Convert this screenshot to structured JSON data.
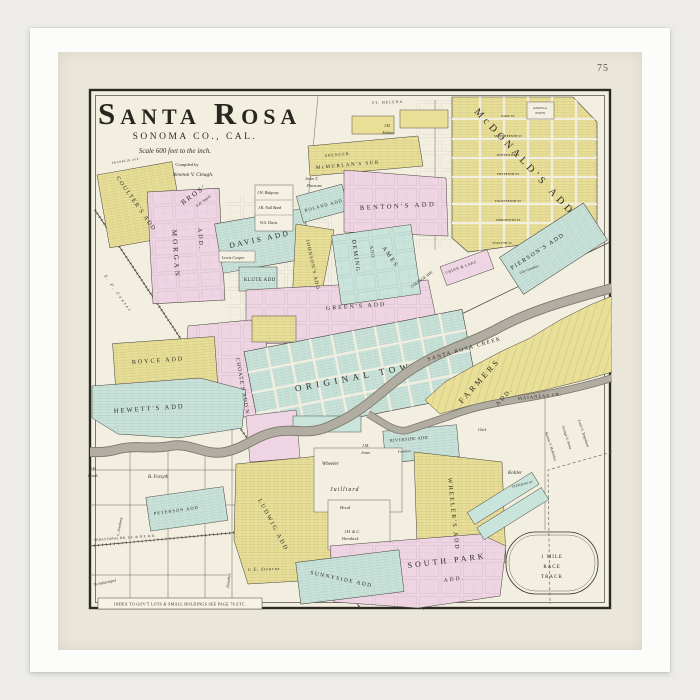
{
  "frame": {
    "page_number": "75"
  },
  "title": {
    "main": "Santa Rosa",
    "county": "SONOMA CO., CAL.",
    "scale": "Scale 600 feet to the inch.",
    "compiled": "Compiled by",
    "compiler": "Newton V. Cleugh."
  },
  "index_note": "INDEX TO GOV'T LOTS & SMALL HOLDINGS SEE PAGE 76 ETC.",
  "colors": {
    "yellow": "#e9df97",
    "pink": "#efd5e3",
    "teal": "#c9e4db",
    "paper": "#f2eee0",
    "creek": "#b2ada2",
    "ink": "#2e2b25"
  },
  "additions": {
    "coulter": "COULTER'S ADD",
    "morgan": "MORGAN",
    "morgan_bros": "BROS'",
    "morgan_add": "ADD.",
    "morgan_sub": "E.H. Smyth",
    "davis": "DAVIS ADD",
    "klute": "KLUTE ADD",
    "roland": "ROLAND ADD",
    "spencer": "SPENCER",
    "mcmurlan": "McMURLAN'S SUB",
    "benton": "BENTON'S ADD",
    "mcdonald": "McDONALD'S ADD",
    "angela_1": "ANGELA",
    "angela_2": "TOWN",
    "pierson": "PIERSON'S ADD",
    "farmers_1": "FARMERS",
    "farmers_2": "ADD.",
    "original_town": "ORIGINAL TOWN",
    "greens": "GREEN'S ADD",
    "deming": "DEMING",
    "deming_add": "ADD",
    "ames": "AMES",
    "johnsons": "JOHNSON'S ADD",
    "choate": "CHOATE'S ADD'N",
    "boyce": "BOYCE ADD",
    "hewett": "HEWETT'S ADD",
    "peterson": "PETERSON ADD",
    "ludwig": "LUDWIG ADD",
    "wheelers": "WHEELER'S ADD",
    "south_park_1": "SOUTH PARK",
    "south_park_2": "ADD.",
    "riverside": "RIVERSIDE ADD",
    "sunnyside": "SUNNYSIDE ADD",
    "chinn_lake": "CHINN & LAKE"
  },
  "streets": {
    "park": "PARK ST",
    "seventeenth": "SEVENTEENTH ST",
    "sixteenth": "SIXTEENTH ST",
    "fifteenth": "FIFTEENTH ST",
    "fourteenth": "FOURTEENTH ST",
    "thirteenth": "THIRTEENTH ST",
    "twelfth": "TWELFTH ST",
    "st_helena": "ST. HELENA",
    "franklin": "FRANKLIN AVE",
    "college": "COLLEGE AVE",
    "stephens": "STEPHENS ST",
    "donahue": "Donahue",
    "city_gardens": "City Gardens"
  },
  "railroads": {
    "sebastopol_branch": "SEBASTOPOL BR. S.F. & N.P. R.R.",
    "sf_center": "S. F. Center",
    "to_sebastopol": "To Sebastopol"
  },
  "creeks": {
    "santa_rosa": "SANTA ROSA CREEK",
    "matanzas": "MATANZAS CR."
  },
  "owners": {
    "ridgway": "J.W. Ridgway",
    "nall": "J.B. Nall Bank",
    "ws_davis": "W.S. Davis",
    "cooper": "Lewis Cooper",
    "parsons_1": "John T.",
    "parsons_2": "Parsons",
    "abshire_1": "J.H.",
    "abshire_2": "Abshire",
    "brush_1": "J.H.",
    "brush_2": "Brush",
    "forsyth": "B. Forsyth",
    "wheeler": "Wheeler",
    "juilliard": "Juilliard",
    "hood": "Hood",
    "jones_1": "J.M.",
    "jones_2": "Jones",
    "hornbeck_1": "J.H. & C.",
    "hornbeck_2": "Hornbeck",
    "kohler": "Kohler",
    "stearns": "C.E. Stearns",
    "smedberg": "C. Smedberg",
    "mckinley": "Nannie V. McKinley",
    "stone": "George A. Stone",
    "templeton": "Louis S. Templeton",
    "freeman": "Freeman",
    "clark": "Clark"
  },
  "racetrack": {
    "l1": "1 MILE",
    "l2": "RACE",
    "l3": "TRACK"
  }
}
